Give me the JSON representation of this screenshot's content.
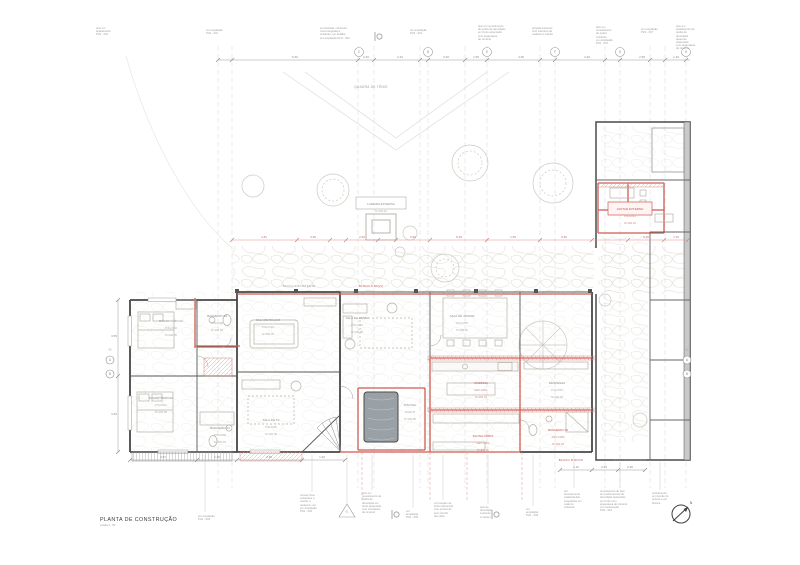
{
  "palette": {
    "new_work_red": "#cf5a52",
    "dim_red": "#df918a",
    "existing_wall": "#474747",
    "annotation_gray": "#9a9a9a",
    "stone_texture": "#e4e0d6",
    "pool_water": "#99a1a6"
  },
  "sheet": {
    "title": "PLANTA DE CONSTRUÇÃO",
    "scale": "escala 1 : 50",
    "north_label": "N",
    "detail_marker": "01"
  },
  "site": {
    "tennis_court": "QUADRA DE TÊNIS"
  },
  "blocks": [
    {
      "label": "BLOCO A EXISTENTE"
    },
    {
      "label": "BLOCO A NOVO"
    },
    {
      "label": "BLOCO B NOVO"
    },
    {
      "label": "BLOCO B EXISTENTE"
    }
  ],
  "rooms": [
    {
      "name": "DORMITÓRIO 02",
      "code": "PIS-C002",
      "level": "N=100,05"
    },
    {
      "name": "BANHEIRO 02",
      "code": "PIS-C008",
      "level": "N=100,03"
    },
    {
      "name": "SALA DE BILHAR",
      "code": "PIS-C003",
      "level": "N=100,05"
    },
    {
      "name": "SALA DE ESTAR",
      "code": "PIS-C004",
      "level": "N=100,05"
    },
    {
      "name": "SALA DE JANTAR",
      "code": "PIS-C005",
      "level": "N=100,05"
    },
    {
      "name": "DORMITÓRIO 01",
      "code": "PIS-C001",
      "level": "N=100,05"
    },
    {
      "name": "BANHEIRO 01",
      "code": "PIS-C009",
      "level": "N=100,03"
    },
    {
      "name": "SALA DE TV",
      "code": "PIS-C006",
      "level": "N=100,05"
    },
    {
      "name": "PISCINA",
      "code": "N=99,75",
      "level": "N=100,05"
    },
    {
      "name": "COZINHA",
      "code": "REV-C001",
      "level": "N=100,03"
    },
    {
      "name": "DESPENSA",
      "code": "PIS-C010",
      "level": "N=100,03"
    },
    {
      "name": "SAUNA ÚMIDA",
      "code": "REV-C002",
      "level": "N=100,00"
    },
    {
      "name": "BANHEIRO 03",
      "code": "REV-C003",
      "level": "N=100,03"
    },
    {
      "name": "JANTAR EXTERNO",
      "code": "PIS-C012",
      "level": "N=100,15"
    },
    {
      "name": "LAREIRA EXTERNA",
      "code": "N=100,10",
      "level": ""
    }
  ],
  "grid_bubbles": [
    "C",
    "D",
    "E",
    "F",
    "G",
    "H"
  ],
  "section_markers": {
    "left_top": "A",
    "left_bottom": "B",
    "left_num": "02",
    "right_top": "A",
    "right_bottom": "B",
    "right_num": "02"
  },
  "top_notes": [
    "piso em\nacabamento\nPLN - 001",
    "ver ampliação\nPLN - 001",
    "em fachada: cobertura\nnova integrada à\nexistente; ver detalhe\nem ampliação PLN - 004",
    "ver ampliação\nPLN - 002",
    "piso em revestimento\nde pedra de demolição\nem bruto assentado\ncom argamassa\nde cimento",
    "pérgola existente\ncom estrutura de\nmadeira a manter",
    "piso em\nrevestimento\nde pedra\nexistente\nver ampliação\nPLN - 007",
    "ver ampliação\nPLN - 007",
    "piso em\nacabamento de\npedra de\ndemolição\naparente\nassentado\ncom argamassa\nde cimento"
  ],
  "bottom_notes": [
    "ver ampliação\nPLN - 003",
    "móveis fixos\nexistentes a\nmanter e\nrestaurar; ver\nem ampliação\nPLN - 004",
    "piso em\nrevestimento de\npedra de\ndemolição em\nbruto assentado\ncom contrapiso\nde cimento",
    "ver\nampliação\nPLN - 005",
    "ver traçado na\nlinha referencial\ncom pontos de\neixo central\ndos vãos",
    "piso de\ndemolição\nexistente\na manter",
    "ver\nampliação\nPLN - 006",
    "ver\nlevantamento\ncadastral das\nesquadrias em\ncaderno\nexistente",
    "revestimento de piso\nem pedra arenito de\ndemolição assentado\nem bruto com\nargamassa de cimento\nver continuação\nPLN - 001",
    "acabamento\nem demão de\npintura a cal\nbranca"
  ],
  "dims": {
    "top": [
      "5.40",
      "2.40",
      "2.43",
      "3.40",
      "1.50",
      "4.36",
      "4.20",
      "2.90",
      "1.16"
    ],
    "red": [
      "1.81",
      "4.36",
      "2.60",
      "0.90",
      "8.29",
      "1.50",
      "5.40",
      "2.35",
      "1.15"
    ],
    "bottom": [
      "3.97",
      "1.45",
      "2.48",
      "1.40"
    ],
    "right": [
      "1.16",
      "0.63",
      "2.35"
    ],
    "left": [
      "3.55",
      "3.60"
    ]
  }
}
